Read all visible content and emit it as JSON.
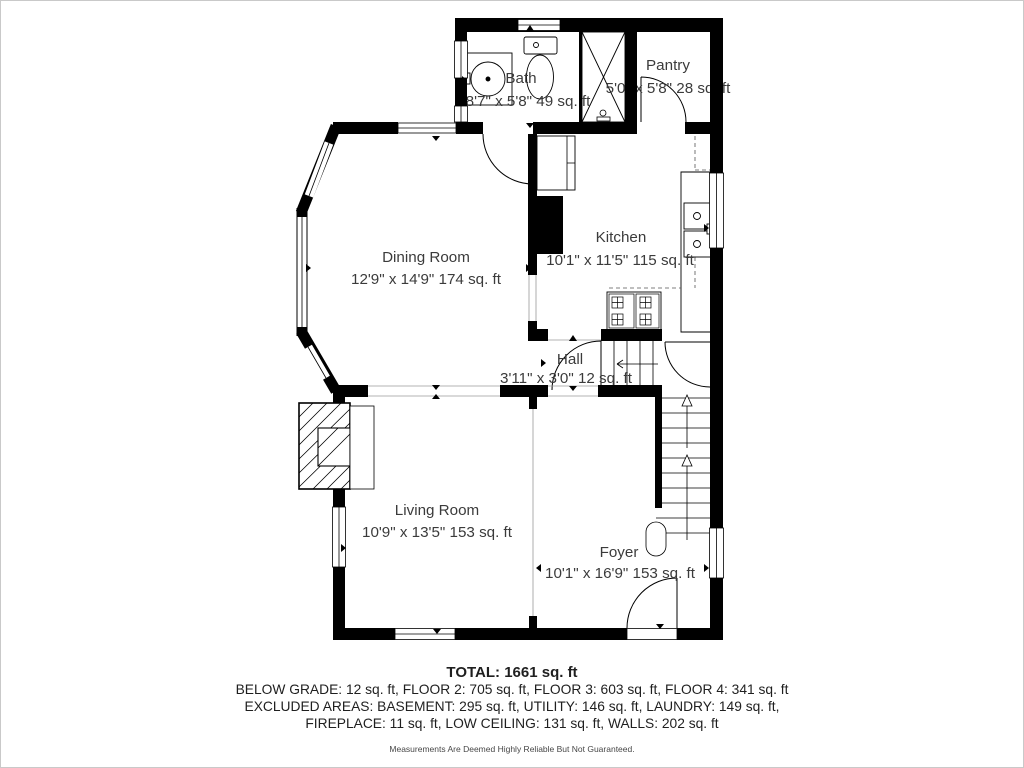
{
  "plan": {
    "rooms": [
      {
        "name": "Bath",
        "dims": "8'7\" x 5'8\" 49 sq. ft"
      },
      {
        "name": "Pantry",
        "dims": "5'0\" x 5'8\" 28 sq. ft"
      },
      {
        "name": "Dining Room",
        "dims": "12'9\" x 14'9\" 174 sq. ft"
      },
      {
        "name": "Kitchen",
        "dims": "10'1\" x 11'5\" 115 sq. ft"
      },
      {
        "name": "Hall",
        "dims": "3'11\" x 3'0\" 12 sq. ft"
      },
      {
        "name": "Living Room",
        "dims": "10'9\" x 13'5\" 153 sq. ft"
      },
      {
        "name": "Foyer",
        "dims": "10'1\" x 16'9\" 153 sq. ft"
      }
    ],
    "fixtures": [
      "bathroom-sink",
      "toilet",
      "shower",
      "pantry-door",
      "kitchen-sink",
      "stove",
      "kitchen-counter",
      "chimney",
      "fireplace",
      "staircase",
      "bay-window",
      "front-door"
    ],
    "summary": {
      "total": "TOTAL: 1661 sq. ft",
      "line1": "BELOW GRADE: 12 sq. ft, FLOOR 2: 705 sq. ft, FLOOR 3: 603 sq. ft, FLOOR 4: 341 sq. ft",
      "line2": "EXCLUDED AREAS: BASEMENT: 295 sq. ft, UTILITY: 146 sq. ft, LAUNDRY: 149 sq. ft,",
      "line3": "FIREPLACE: 11 sq. ft, LOW CEILING: 131 sq. ft, WALLS: 202 sq. ft",
      "disclaimer": "Measurements Are Deemed Highly Reliable But Not Guaranteed."
    },
    "colors": {
      "wall": "#000000",
      "room_text": "#3b3b3b",
      "summary_text": "#1f1f1f"
    }
  }
}
